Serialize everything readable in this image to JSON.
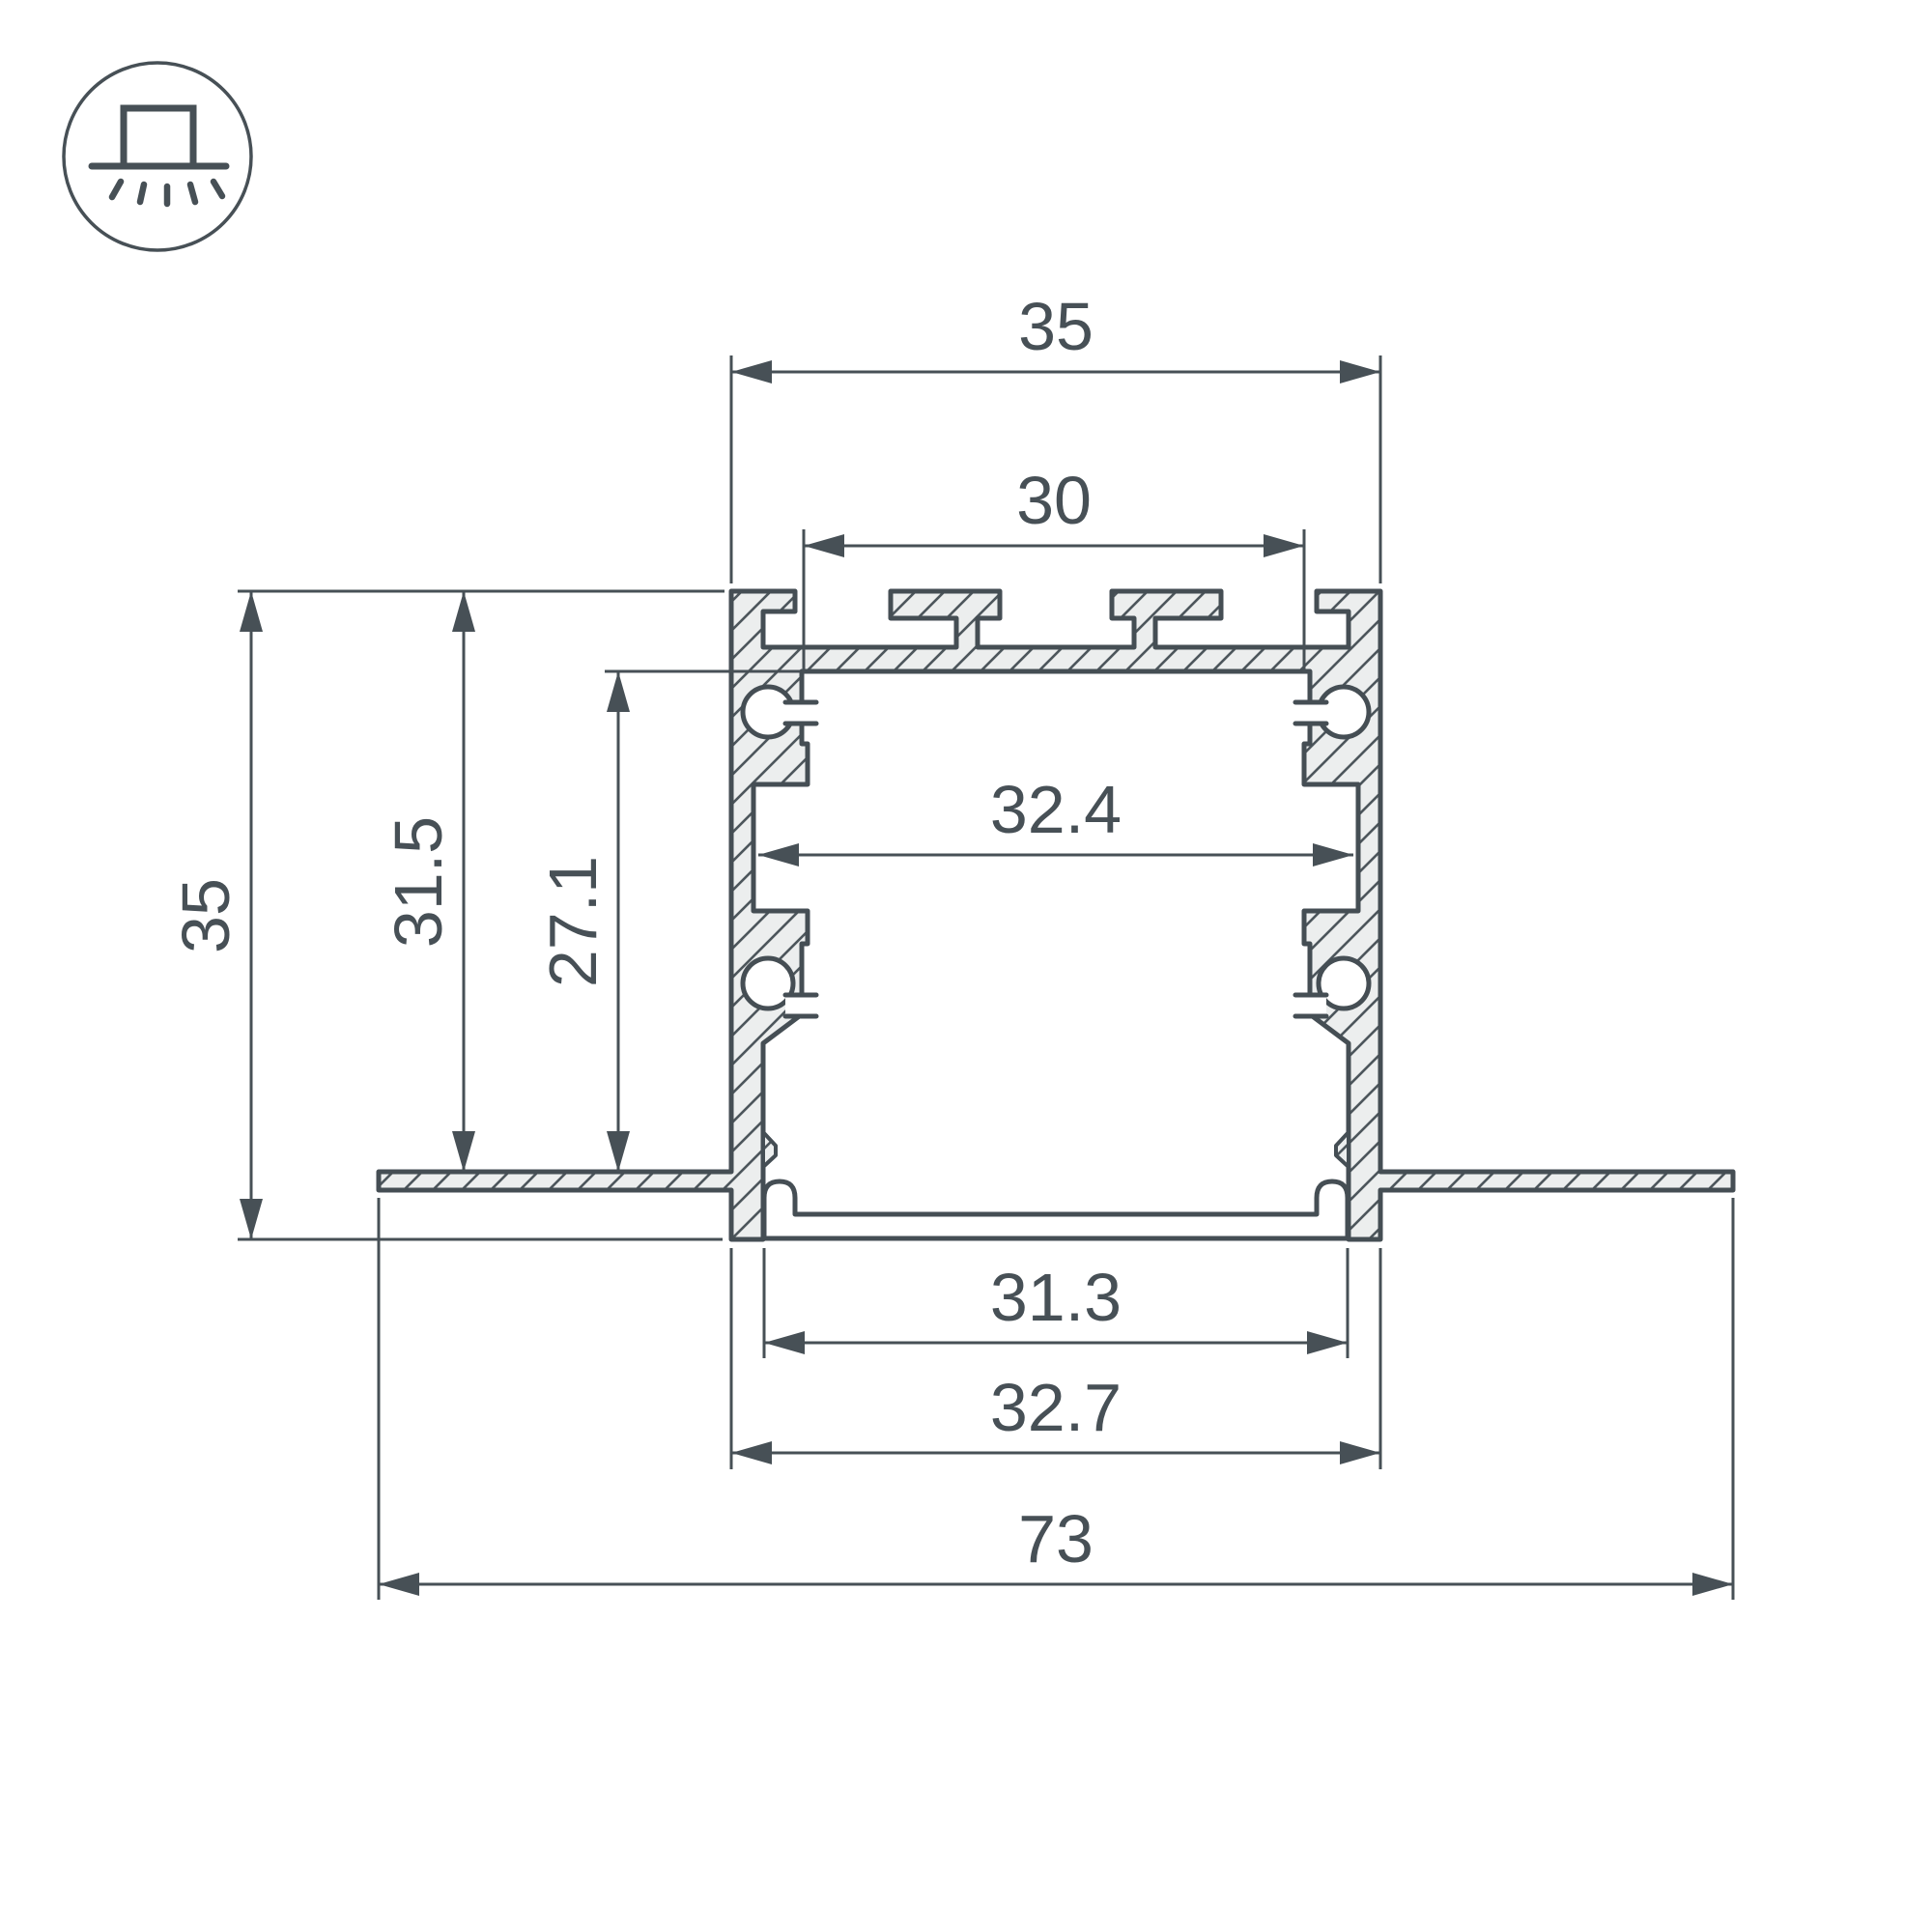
{
  "icon": {
    "name": "recessed-mount-icon",
    "description": "recessed ceiling luminaire symbol"
  },
  "drawing": {
    "type": "aluminum-profile-cross-section",
    "colors": {
      "line": "#475056",
      "outline": "#454e54",
      "metal_fill": "#eceeee",
      "background": "#ffffff"
    },
    "dimensions": {
      "top_width": "35",
      "top_slot_width": "30",
      "inner_width": "32.4",
      "bottom_inner_width": "31.3",
      "bottom_width": "32.7",
      "overall_width": "73",
      "overall_height": "35",
      "recess_height": "31.5",
      "cavity_height": "27.1"
    }
  }
}
